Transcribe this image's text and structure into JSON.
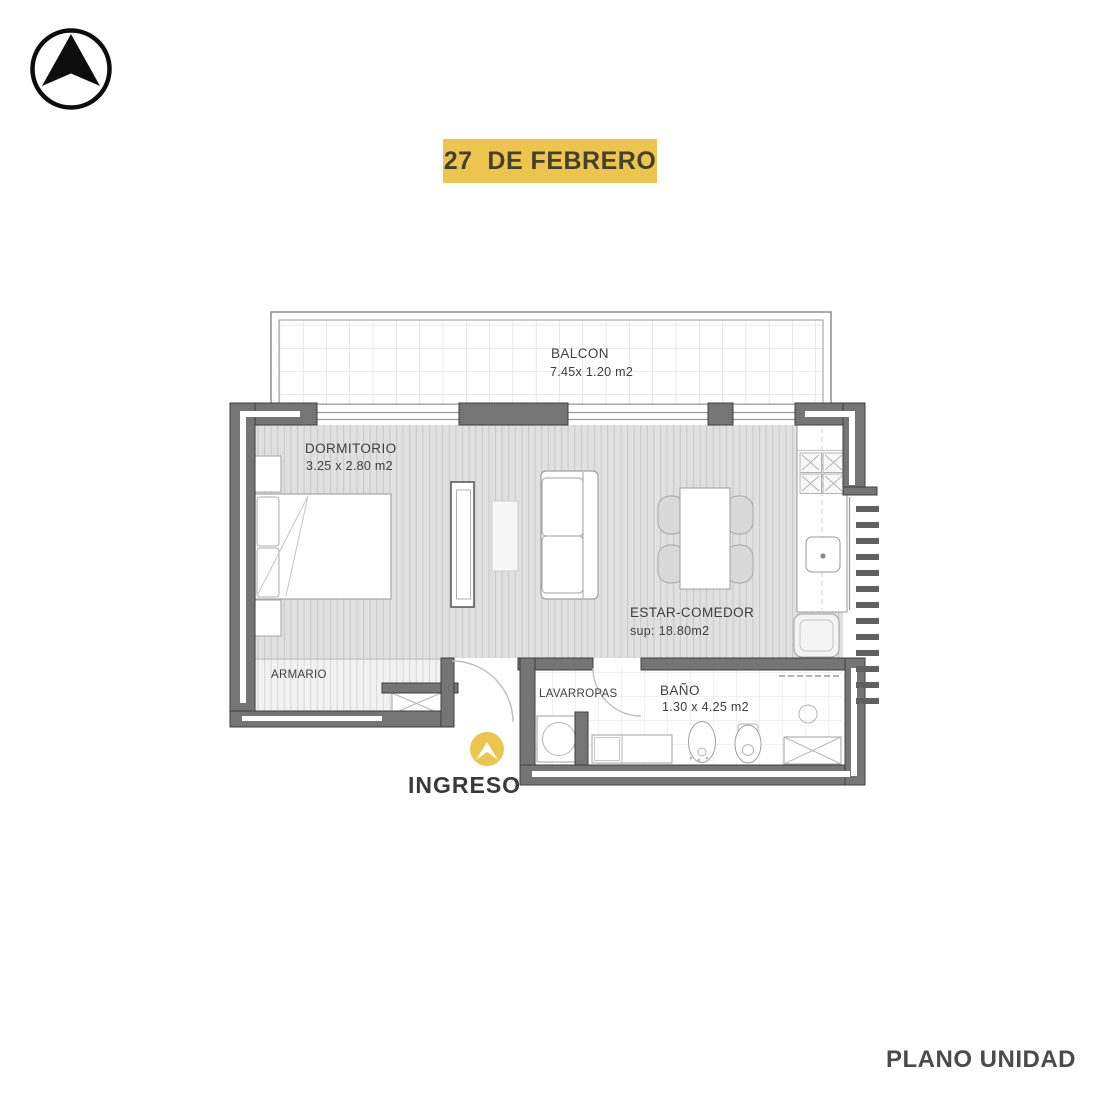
{
  "banner": {
    "title": "27  DE FEBRERO"
  },
  "footer": {
    "title": "PLANO UNIDAD"
  },
  "colors": {
    "accent_yellow": "#EDC44E",
    "wall_gray": "#757575",
    "text_dark": "#3E3E3E",
    "floor_gray": "#E0E0E0"
  },
  "rooms": {
    "balcon": {
      "name": "BALCON",
      "dims": "7.45x 1.20 m2"
    },
    "dormitorio": {
      "name": "DORMITORIO",
      "dims": "3.25 x 2.80 m2"
    },
    "estar_comedor": {
      "name": "ESTAR-COMEDOR",
      "dims": "sup: 18.80m2"
    },
    "armario": {
      "name": "ARMARIO"
    },
    "lavarropas": {
      "name": "LAVARROPAS"
    },
    "bano": {
      "name": "BAÑO",
      "dims": "1.30 x 4.25 m2"
    },
    "ingreso": {
      "name": "INGRESO"
    }
  }
}
